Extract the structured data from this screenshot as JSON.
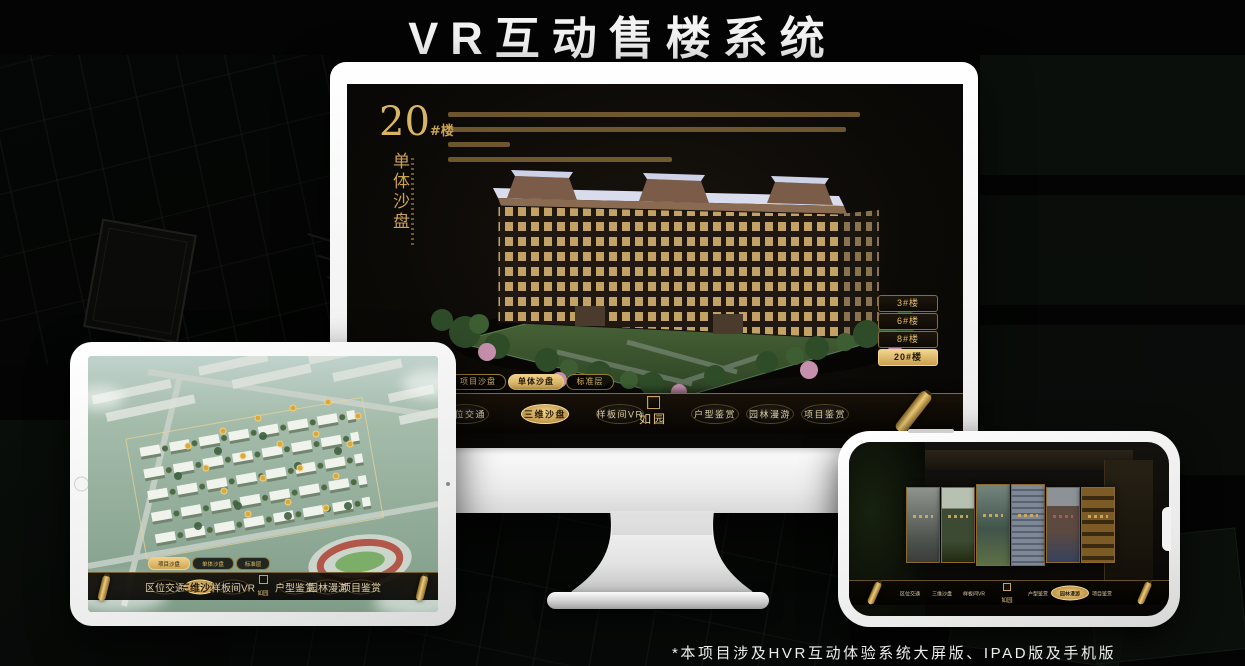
{
  "page": {
    "title": "VR互动售楼系统",
    "footnote": "*本项目涉及HVR互动体验系统大屏版、IPAD版及手机版"
  },
  "colors": {
    "gold": "#D8B565",
    "gold_bright": "#EFCF8A",
    "screen_bg": "#0C0A07",
    "active_text": "#2B1C06"
  },
  "monitor": {
    "building_label": {
      "number": "20",
      "unit": "#楼",
      "subtitle": "单体沙盘"
    },
    "floor_buttons": [
      {
        "label": "3#楼",
        "active": false
      },
      {
        "label": "6#楼",
        "active": false
      },
      {
        "label": "8#楼",
        "active": false
      },
      {
        "label": "20#楼",
        "active": true
      }
    ],
    "sub_tabs": [
      {
        "label": "项目沙盘",
        "active": false
      },
      {
        "label": "单体沙盘",
        "active": true
      },
      {
        "label": "标准层",
        "active": false
      }
    ],
    "nav": {
      "logo": "如园",
      "items": [
        {
          "label": "区位交通",
          "active": false
        },
        {
          "label": "三维沙盘",
          "active": true
        },
        {
          "label": "样板间VR",
          "active": false
        },
        {
          "label": "户型鉴赏",
          "active": false
        },
        {
          "label": "园林漫游",
          "active": false
        },
        {
          "label": "项目鉴赏",
          "active": false
        }
      ]
    }
  },
  "tablet": {
    "sub_tabs": [
      {
        "label": "项目沙盘",
        "active": true
      },
      {
        "label": "单体沙盘",
        "active": false
      },
      {
        "label": "标准层",
        "active": false
      }
    ],
    "nav": {
      "logo": "如园",
      "items": [
        {
          "label": "区位交通",
          "active": false
        },
        {
          "label": "三维沙盘",
          "active": true
        },
        {
          "label": "样板间VR",
          "active": false
        },
        {
          "label": "户型鉴赏",
          "active": false
        },
        {
          "label": "园林漫游",
          "active": false
        },
        {
          "label": "项目鉴赏",
          "active": false
        }
      ]
    }
  },
  "phone": {
    "nav": {
      "logo": "如园",
      "items": [
        {
          "label": "区位交通",
          "active": false
        },
        {
          "label": "三维沙盘",
          "active": false
        },
        {
          "label": "样板间VR",
          "active": false
        },
        {
          "label": "户型鉴赏",
          "active": false
        },
        {
          "label": "园林漫游",
          "active": true
        },
        {
          "label": "项目鉴赏",
          "active": false
        }
      ]
    }
  }
}
